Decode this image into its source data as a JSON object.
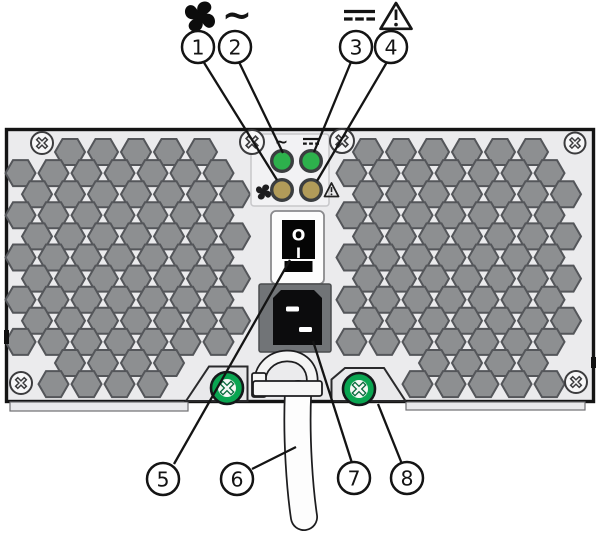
{
  "diagram": {
    "description": "Power supply rear panel with numbered callouts",
    "callouts": [
      {
        "number": "1"
      },
      {
        "number": "2"
      },
      {
        "number": "3"
      },
      {
        "number": "4"
      },
      {
        "number": "5"
      },
      {
        "number": "6"
      },
      {
        "number": "7"
      },
      {
        "number": "8"
      }
    ],
    "legend_symbols": [
      {
        "name": "fan-icon"
      },
      {
        "name": "ac-symbol",
        "glyph": "~"
      },
      {
        "name": "dc-symbol"
      },
      {
        "name": "warning-icon",
        "glyph": "!"
      }
    ],
    "panel_symbols": [
      {
        "name": "ac-symbol-small",
        "glyph": "~"
      },
      {
        "name": "dc-symbol-small"
      },
      {
        "name": "fan-icon-small"
      },
      {
        "name": "warning-icon-small",
        "glyph": "!"
      }
    ],
    "switch_markings": {
      "off": "O",
      "on": "I"
    },
    "colors": {
      "led_green": "#2db14c",
      "led_amber": "#b19b59",
      "led_ring": "#3b3e40",
      "thumbscrew_green": "#0aa551",
      "panel_face": "#ebebed",
      "led_panel_face": "#f2f2f4",
      "hex_fill": "#8d8f91",
      "hex_stroke": "#54565a",
      "outline": "#141414"
    }
  }
}
